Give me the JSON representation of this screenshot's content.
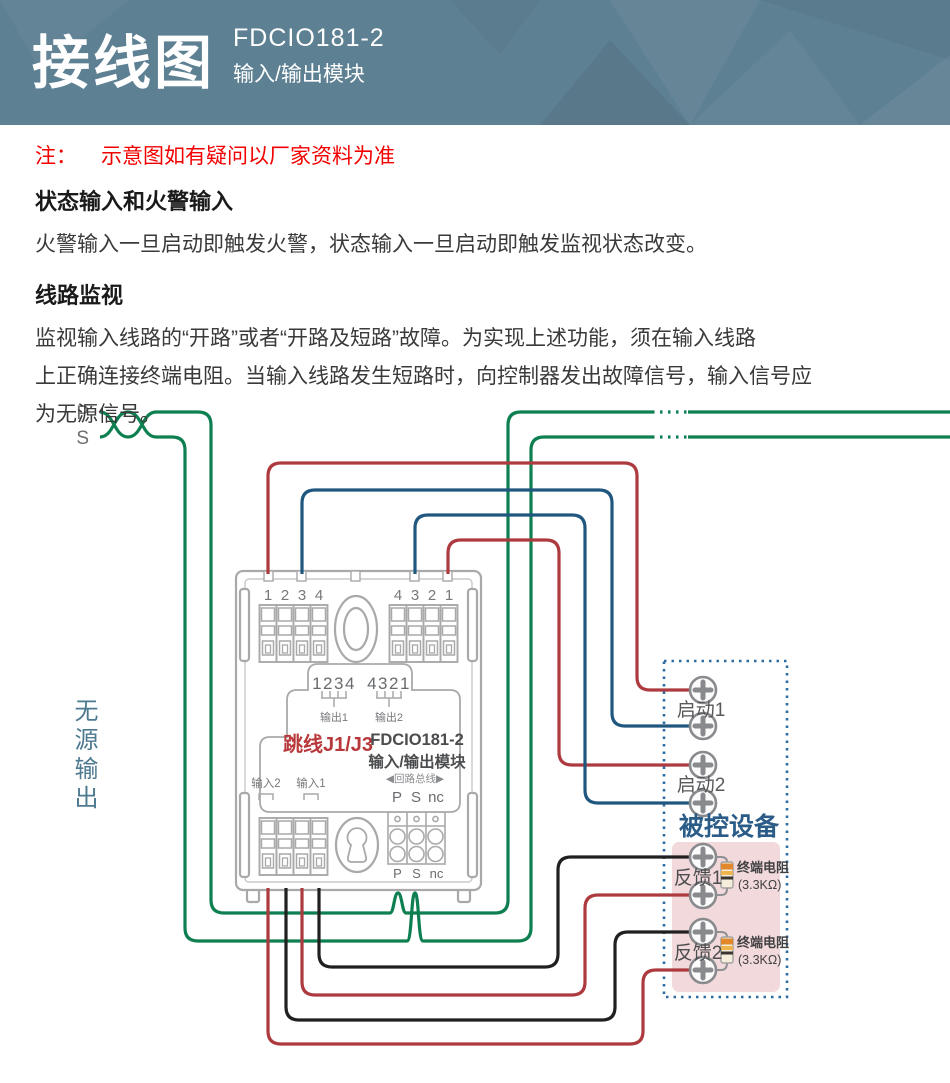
{
  "header": {
    "title": "接线图",
    "model": "FDCIO181-2",
    "subtitle": "输入/输出模块"
  },
  "notes": {
    "note_prefix": "注：",
    "note_text": "示意图如有疑问以厂家资料为准",
    "h1": "状态输入和火警输入",
    "p1": "火警输入一旦启动即触发火警，状态输入一旦启动即触发监视状态改变。",
    "h2": "线路监视",
    "p2": "监视输入线路的“开路”或者“开路及短路”故障。为实现上述功能，须在输入线路\n上正确连接终端电阻。当输入线路发生短路时，向控制器发出故障信号，输入信号应\n为无源信号。"
  },
  "diagram": {
    "ps": {
      "p": "P",
      "s": "S"
    },
    "left_label": "无源输出",
    "module": {
      "tl_nums": [
        "1",
        "2",
        "3",
        "4"
      ],
      "tr_nums": [
        "4",
        "3",
        "2",
        "1"
      ],
      "jumper_nums_left": "1234",
      "jumper_nums_right": "4321",
      "out1": "输出1",
      "out2": "输出2",
      "jumper_label": "跳线J1/J3",
      "model": "FDCIO181-2",
      "model_name": "输入/输出模块",
      "in2": "输入2",
      "in1": "输入1",
      "loop_bus": "◀回路总线▶",
      "pin_p": "P",
      "pin_s": "S",
      "pin_nc": "nc"
    },
    "right": {
      "start1": "启动1",
      "start2": "启动2",
      "device": "被控设备",
      "fb1": "反馈1",
      "fb2": "反馈2",
      "resistor": "终端电阻",
      "resistor_value": "(3.3KΩ)"
    },
    "colors": {
      "green": "#0d7f50",
      "red": "#ad3a3e",
      "blue": "#20577f",
      "black": "#221f1f",
      "module_gray": "#a9a9a9",
      "box_border": "#2e6da3",
      "pink": "#f2d9db",
      "device_blue": "#2b5c88",
      "label_gray": "#6d6e71",
      "note_red": "#f20000"
    }
  }
}
